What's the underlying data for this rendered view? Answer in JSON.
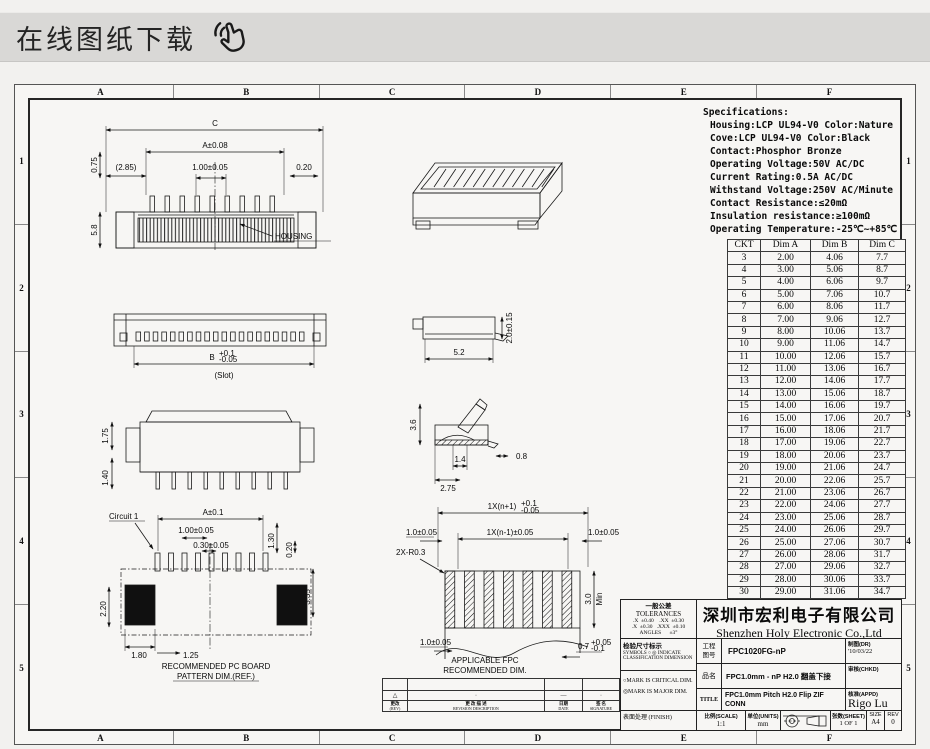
{
  "header": {
    "title": "在线图纸下载"
  },
  "grid": {
    "cols": [
      "A",
      "B",
      "C",
      "D",
      "E",
      "F"
    ],
    "rows": [
      "1",
      "2",
      "3",
      "4",
      "5"
    ]
  },
  "specs": {
    "title": "Specifications:",
    "lines": [
      "Housing:LCP UL94-V0 Color:Nature",
      "Cove:LCP UL94-V0 Color:Black",
      "Contact:Phosphor Bronze",
      "Operating Voltage:50V AC/DC",
      "Current Rating:0.5A AC/DC",
      "Withstand Voltage:250V AC/Minute",
      "Contact Resistance:≤20mΩ",
      "Insulation resistance:≥100mΩ",
      "Operating Temperature:-25℃~+85℃"
    ]
  },
  "dim_table": {
    "headers": [
      "CKT",
      "Dim A",
      "Dim B",
      "Dim C"
    ],
    "rows": [
      [
        "3",
        "2.00",
        "4.06",
        "7.7"
      ],
      [
        "4",
        "3.00",
        "5.06",
        "8.7"
      ],
      [
        "5",
        "4.00",
        "6.06",
        "9.7"
      ],
      [
        "6",
        "5.00",
        "7.06",
        "10.7"
      ],
      [
        "7",
        "6.00",
        "8.06",
        "11.7"
      ],
      [
        "8",
        "7.00",
        "9.06",
        "12.7"
      ],
      [
        "9",
        "8.00",
        "10.06",
        "13.7"
      ],
      [
        "10",
        "9.00",
        "11.06",
        "14.7"
      ],
      [
        "11",
        "10.00",
        "12.06",
        "15.7"
      ],
      [
        "12",
        "11.00",
        "13.06",
        "16.7"
      ],
      [
        "13",
        "12.00",
        "14.06",
        "17.7"
      ],
      [
        "14",
        "13.00",
        "15.06",
        "18.7"
      ],
      [
        "15",
        "14.00",
        "16.06",
        "19.7"
      ],
      [
        "16",
        "15.00",
        "17.06",
        "20.7"
      ],
      [
        "17",
        "16.00",
        "18.06",
        "21.7"
      ],
      [
        "18",
        "17.00",
        "19.06",
        "22.7"
      ],
      [
        "19",
        "18.00",
        "20.06",
        "23.7"
      ],
      [
        "20",
        "19.00",
        "21.06",
        "24.7"
      ],
      [
        "21",
        "20.00",
        "22.06",
        "25.7"
      ],
      [
        "22",
        "21.00",
        "23.06",
        "26.7"
      ],
      [
        "23",
        "22.00",
        "24.06",
        "27.7"
      ],
      [
        "24",
        "23.00",
        "25.06",
        "28.7"
      ],
      [
        "25",
        "24.00",
        "26.06",
        "29.7"
      ],
      [
        "26",
        "25.00",
        "27.06",
        "30.7"
      ],
      [
        "27",
        "26.00",
        "28.06",
        "31.7"
      ],
      [
        "28",
        "27.00",
        "29.06",
        "32.7"
      ],
      [
        "29",
        "28.00",
        "30.06",
        "33.7"
      ],
      [
        "30",
        "29.00",
        "31.06",
        "34.7"
      ]
    ]
  },
  "views": {
    "front": {
      "c": "C",
      "a": "A±0.08",
      "pitch": "1.00±0.05",
      "d020": "0.20",
      "d285": "(2.85)",
      "d075": "0.75",
      "d58": "5.8",
      "housing": "HOUSING"
    },
    "bottom": {
      "b": "B",
      "tol_plus": "+0.1",
      "tol_minus": "-0.05",
      "slot": "(Slot)"
    },
    "rear": {
      "d175": "1.75",
      "d140": "1.40"
    },
    "pcb": {
      "circuit": "Circuit 1",
      "a": "A±0.1",
      "pitch": "1.00±0.05",
      "pad": "0.30±0.05",
      "d130": "1.30",
      "d020": "0.20",
      "d335": "3.35",
      "d220": "2.20",
      "d180": "1.80",
      "d125": "1.25",
      "cap1": "RECOMMENDED PC BOARD",
      "cap2": "PATTERN DIM.(REF.)"
    },
    "closed": {
      "d52": "5.2",
      "h": "2.0±0.15"
    },
    "open": {
      "d36": "3.6",
      "d14": "1.4",
      "d275": "2.75",
      "d08": "0.8"
    },
    "fpc": {
      "outer": "1X(n+1)",
      "outer_tp": "+0.1",
      "outer_tm": "-0.05",
      "inner": "1X(n-1)±0.05",
      "ml": "1.0±0.05",
      "mr": "1.0±0.05",
      "radius": "2X-R0.3",
      "h30": "3.0",
      "min": "Min",
      "bl": "1.0±0.05",
      "br": "0.7",
      "br_tp": "+0.05",
      "br_tm": "-0.1",
      "cap1": "APPLICABLE FPC",
      "cap2": "RECOMMENDED DIM."
    }
  },
  "title_block": {
    "tol_zh": "一般公差",
    "tol_en": "TOLERANCES",
    "tol_l1": ".X  ±0.40    .XX  ±0.30",
    "tol_l2": ".X  ±0.30   .XXX  ±0.10",
    "tol_l3": "ANGLES      ±3°",
    "company_zh": "深圳市宏利电子有限公司",
    "company_en": "Shenzhen Holy Electronic Co.,Ltd",
    "insp_zh": "检验尺寸标示",
    "insp_l1": "SYMBOLS ○ ◎ INDICATE",
    "insp_l2": "CLASSIFICATION DIMENSION",
    "mark1": "○MARK IS CRITICAL DIM.",
    "mark2": "◎MARK IS MAJOR DIM.",
    "finish": "表面处理 (FINISH)",
    "partno_label_1": "工程",
    "partno_label_2": "图号",
    "partno": "FPC1020FG-nP",
    "dr_label": "制图(DR)",
    "dr_value": "'10/03/22",
    "product_label": "品名",
    "product": "FPC1.0mm - nP H2.0 翻盖下接",
    "chkd_label": "审核(CHKD)",
    "title_label": "TITLE",
    "title_value_1": "FPC1.0mm Pitch H2.0  Flip ZIF",
    "title_value_2": "CONN",
    "appd_label": "核准(APPD)",
    "appd_value": "Rigo Lu",
    "scale_label": "比例(SCALE)",
    "scale_value": "1:1",
    "units_label": "单位(UNITS)",
    "units_value": "mm",
    "sheet_label": "张数(SHEET)",
    "sheet_value": "1 OF 1",
    "size_label": "SIZE",
    "size_value": "A4",
    "rev_label": "REV",
    "rev_value": "0"
  },
  "revision": {
    "marks": [
      "△",
      "·",
      "—",
      "·"
    ],
    "labels": [
      {
        "zh": "更改",
        "en": "(REV)"
      },
      {
        "zh": "更 改 描 述",
        "en": "REVISION DESCRIPTION"
      },
      {
        "zh": "日期",
        "en": "DATE"
      },
      {
        "zh": "签 名",
        "en": "SIGNATURE"
      }
    ]
  }
}
